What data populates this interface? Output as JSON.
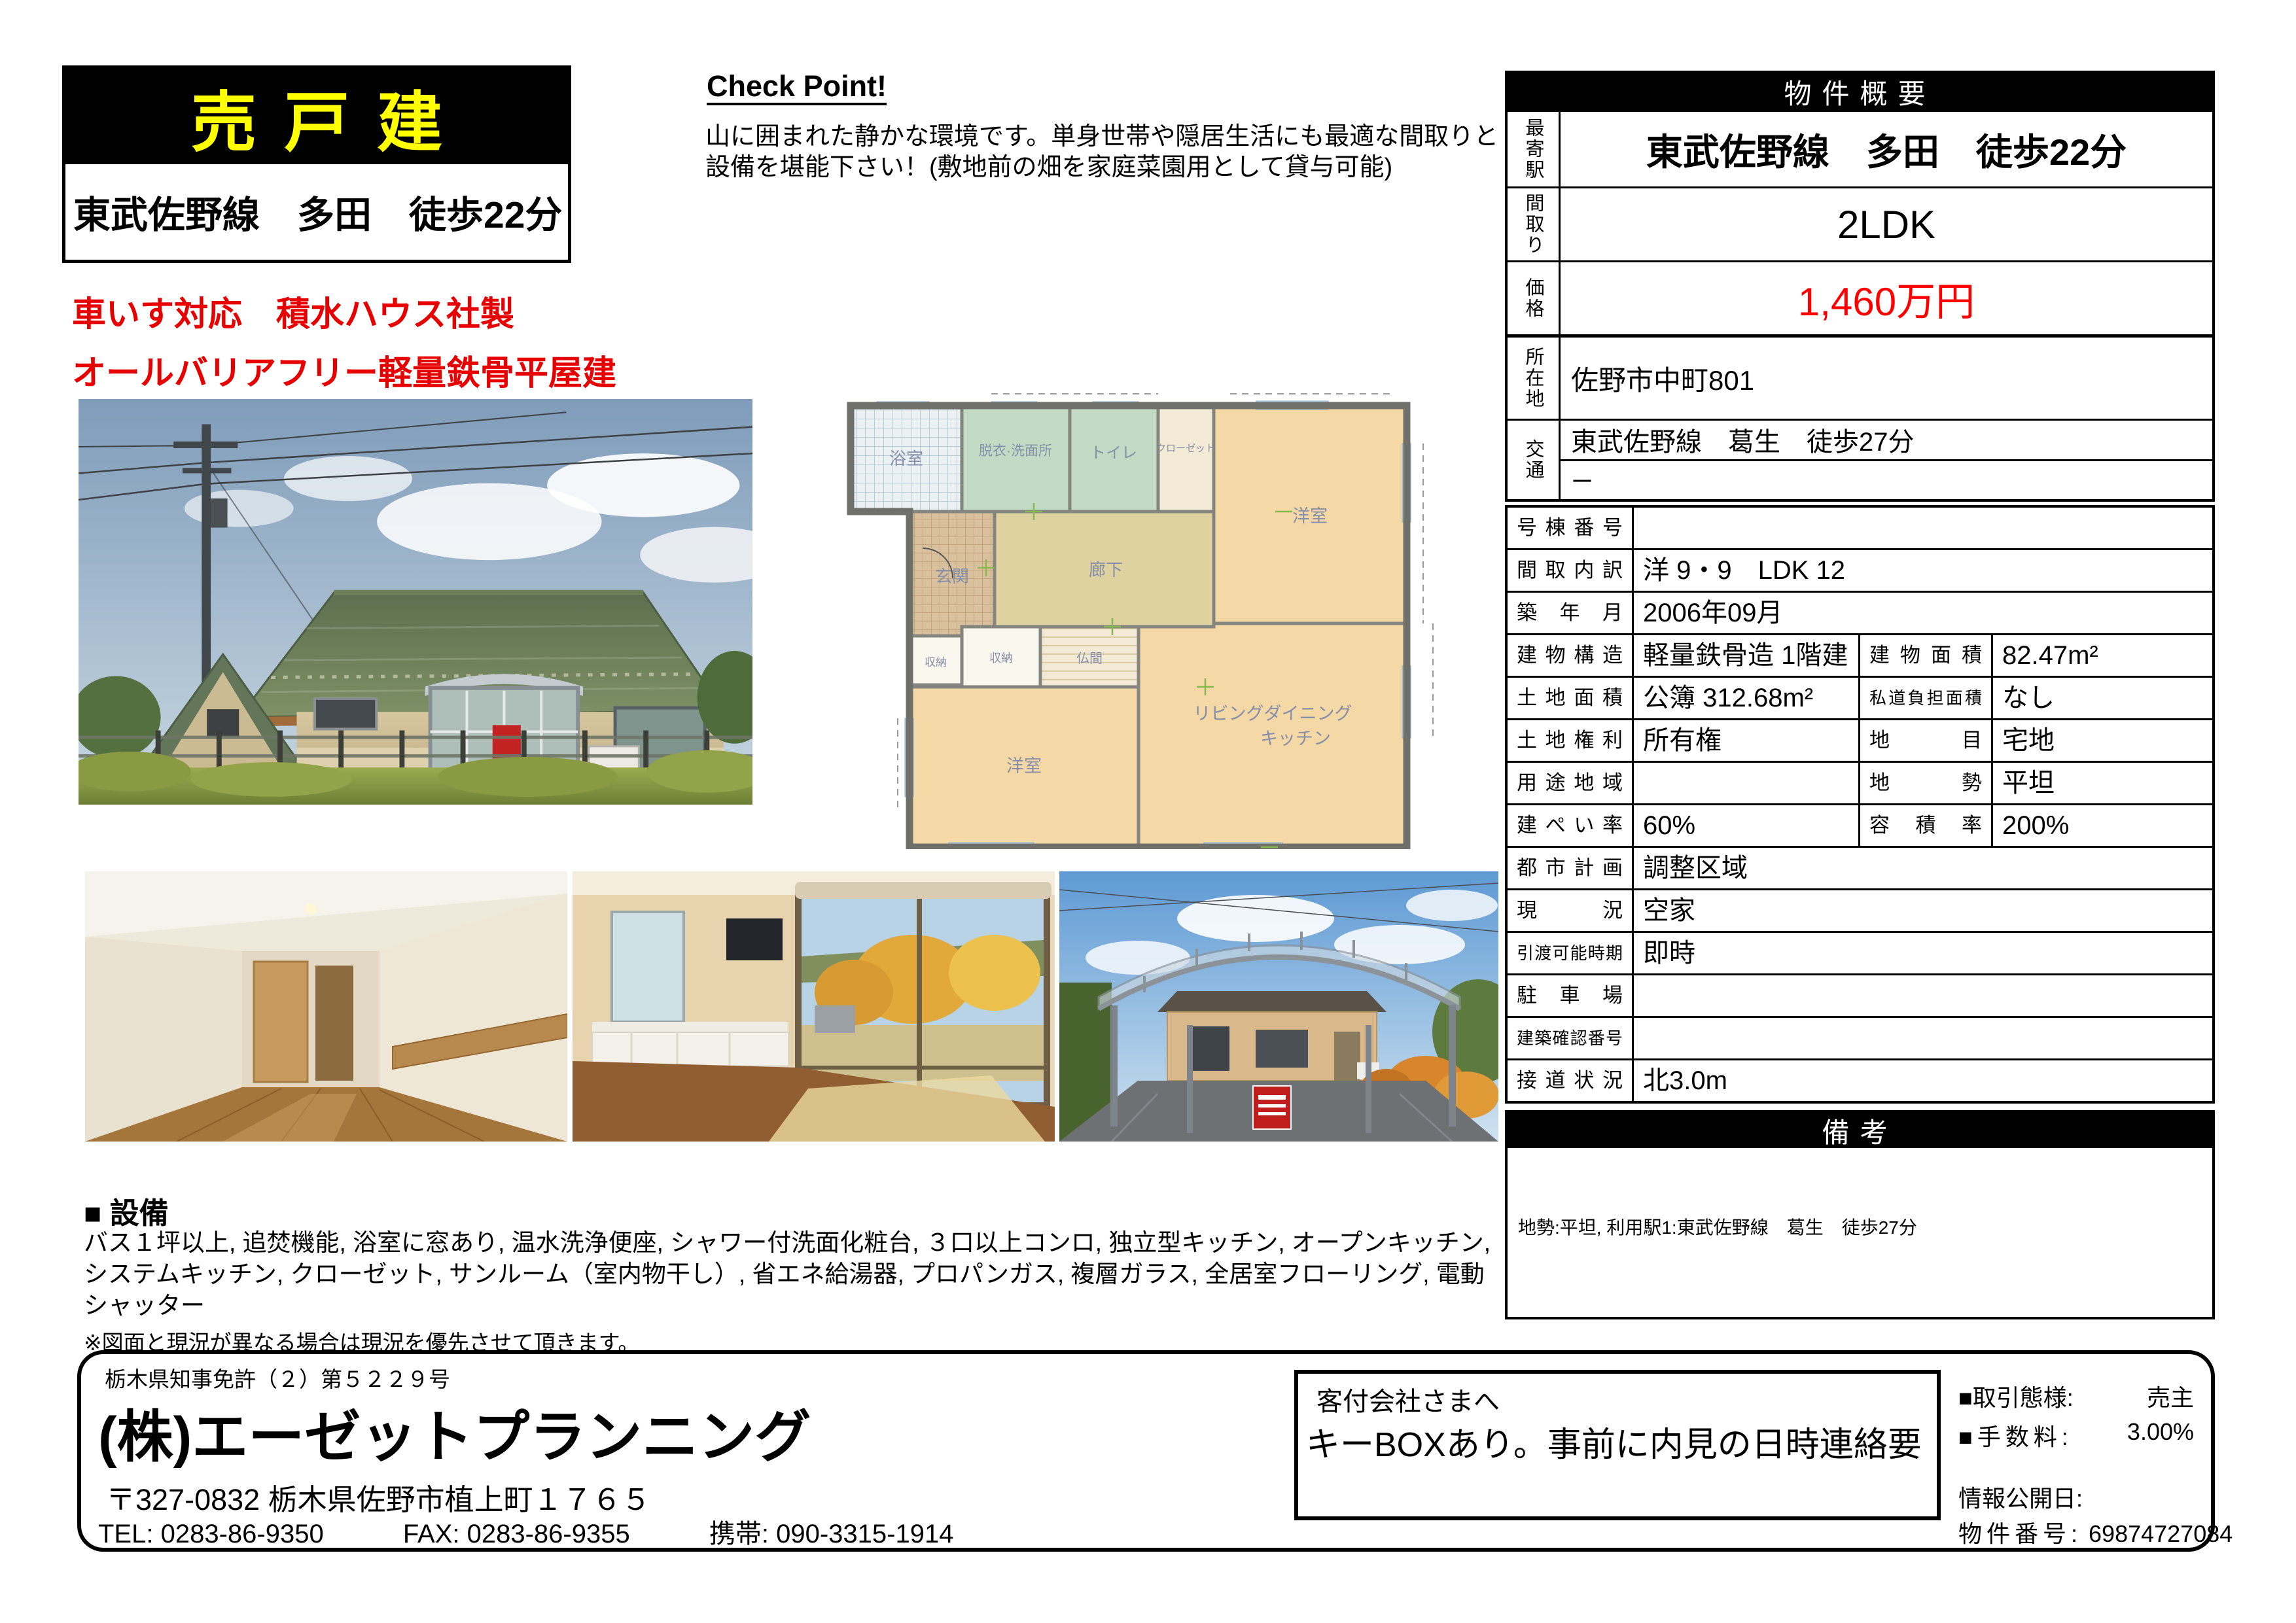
{
  "banner": {
    "sale_type": "売戸建",
    "station": "東武佐野線　多田　徒歩22分"
  },
  "highlights": {
    "line1": "車いす対応　積水ハウス社製",
    "line2": "オールバリアフリー軽量鉄骨平屋建"
  },
  "check_point": {
    "title": "Check Point!",
    "body": "山に囲まれた静かな環境です。単身世帯や隠居生活にも最適な間取りと設備を堪能下さい！(敷地前の畑を家庭菜園用として貸与可能)"
  },
  "overview": {
    "header": "物件概要",
    "station_label": "最寄駅",
    "station": "東武佐野線　多田　徒歩22分",
    "layout_label": "間取り",
    "layout": "2LDK",
    "price_label": "価格",
    "price": "1,460万円"
  },
  "location": {
    "label": "所在地",
    "value": "佐野市中町801",
    "access_label": "交通",
    "access1": "東武佐野線　葛生　徒歩27分",
    "access2": "ー"
  },
  "details": {
    "rows": [
      {
        "label": "号棟番号",
        "value": ""
      },
      {
        "label": "間取内訳",
        "value": "洋 9・9　LDK 12"
      },
      {
        "label": "築年月",
        "value": "2006年09月"
      },
      {
        "label": "建物構造",
        "value": "軽量鉄骨造 1階建",
        "label2": "建物面積",
        "value2": "82.47m²"
      },
      {
        "label": "土地面積",
        "value": "公簿 312.68m²",
        "label2": "私道負担面積",
        "value2": "なし"
      },
      {
        "label": "土地権利",
        "value": "所有権",
        "label2": "地目",
        "value2": "宅地"
      },
      {
        "label": "用途地域",
        "value": "",
        "label2": "地勢",
        "value2": "平坦"
      },
      {
        "label": "建ぺい率",
        "value": "60%",
        "label2": "容積率",
        "value2": "200%"
      },
      {
        "label": "都市計画",
        "value": "調整区域"
      },
      {
        "label": "現況",
        "value": "空家"
      },
      {
        "label": "引渡可能時期",
        "value": "即時"
      },
      {
        "label": "駐車場",
        "value": ""
      },
      {
        "label": "建築確認番号",
        "value": ""
      },
      {
        "label": "接道状況",
        "value": "北3.0m"
      }
    ]
  },
  "remarks": {
    "header": "備考",
    "body": "地勢:平坦, 利用駅1:東武佐野線　葛生　徒歩27分"
  },
  "equipment": {
    "title": "■ 設備",
    "body": "バス１坪以上, 追焚機能, 浴室に窓あり, 温水洗浄便座, シャワー付洗面化粧台, ３口以上コンロ, 独立型キッチン, オープンキッチン, システムキッチン, クローゼット, サンルーム（室内物干し）, 省エネ給湯器, プロパンガス, 複層ガラス, 全居室フローリング, 電動シャッター"
  },
  "disclaimer": "※図面と現況が異なる場合は現況を優先させて頂きます。",
  "company": {
    "license": "栃木県知事免許（２）第５２２９号",
    "name": "(株)エーゼットプランニング",
    "address": "〒327-0832 栃木県佐野市植上町１７６５",
    "tel": "TEL:  0283-86-9350",
    "fax": "FAX:  0283-86-9355",
    "mobile": "携帯: 090-3315-1914"
  },
  "agent_note": {
    "heading": "客付会社さまへ",
    "body": "キーBOXあり。事前に内見の日時連絡要"
  },
  "deal": {
    "type_label": "■取引態様:",
    "type_value": "売主",
    "fee_label": "■手数料:",
    "fee_value": "3.00%",
    "publish_label": "情報公開日:",
    "property_no_label": "物件番号:",
    "property_no_value": "69874727084"
  },
  "floorplan": {
    "bath": "浴室",
    "washroom": "脱衣·洗面所",
    "toilet": "トイレ",
    "closet": "クローゼット",
    "bedroom1": "洋室",
    "entrance": "玄関",
    "hallway": "廊下",
    "storage1": "収納",
    "storage2": "収納",
    "altar_room": "仏間",
    "bedroom2": "洋室",
    "ldk1": "リビングダイニング",
    "ldk2": "キッチン"
  },
  "colors": {
    "accent_red": "#e60000",
    "price_red": "#ff0000",
    "banner_yellow": "#ffff00",
    "roof_green": "#5f7354",
    "wall_tan": "#cfc098"
  }
}
